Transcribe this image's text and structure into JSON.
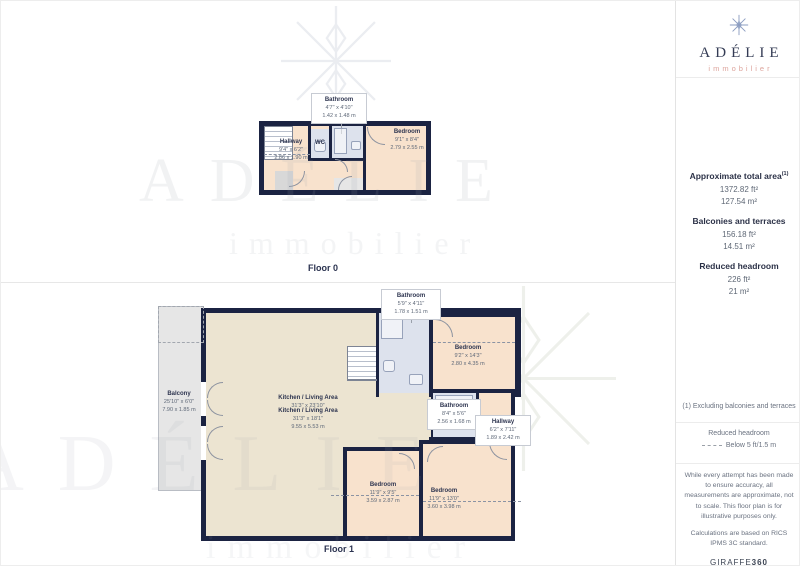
{
  "brand": {
    "name": "ADÉLIE",
    "sub": "immobilier"
  },
  "watermark": {
    "line1": "ADÉLIE",
    "line2": "immobilier"
  },
  "sidebar": {
    "total_area": {
      "label": "Approximate total area",
      "sup": "(1)",
      "ft": "1372.82 ft²",
      "m": "127.54 m²"
    },
    "balconies": {
      "label": "Balconies and terraces",
      "ft": "156.18 ft²",
      "m": "14.51 m²"
    },
    "reduced": {
      "label": "Reduced headroom",
      "ft": "226 ft²",
      "m": "21 m²"
    },
    "note": "(1) Excluding balconies and terraces",
    "legend": {
      "title": "Reduced headroom",
      "item": "Below 5 ft/1.5 m"
    },
    "disclaimer1": "While every attempt has been made to ensure accuracy, all measurements are approximate, not to scale. This floor plan is for illustrative purposes only.",
    "disclaimer2": "Calculations are based on RICS IPMS 3C standard.",
    "giraffe": {
      "name": "GIRAFFE",
      "num": "360"
    }
  },
  "floor0": {
    "label": "Floor 0",
    "rooms": {
      "bathroom_callout": {
        "name": "Bathroom",
        "imperial": "4'7\" x 4'10\"",
        "metric": "1.42 x 1.48 m"
      },
      "hallway": {
        "name": "Hallway",
        "imperial": "9'4\" x 6'2\"",
        "metric": "2.86 x 1.90 m"
      },
      "wc": {
        "name": "WC"
      },
      "bedroom": {
        "name": "Bedroom",
        "imperial": "9'1\" x 8'4\"",
        "metric": "2.79 x 2.55 m"
      }
    }
  },
  "floor1": {
    "label": "Floor 1",
    "rooms": {
      "bathroom_callout": {
        "name": "Bathroom",
        "imperial": "5'9\" x 4'11\"",
        "metric": "1.78 x 1.51 m"
      },
      "balcony": {
        "name": "Balcony",
        "imperial": "25'10\" x 6'0\"",
        "metric": "7.90 x 1.85 m"
      },
      "kitchen_a": {
        "name": "Kitchen / Living Area",
        "imperial": "31'3\" x 23'10\""
      },
      "kitchen_b": {
        "name": "Kitchen / Living Area",
        "imperial": "31'3\" x 18'1\"",
        "metric": "9.55 x 5.53 m"
      },
      "bedroom_tr": {
        "name": "Bedroom",
        "imperial": "9'2\" x 14'3\"",
        "metric": "2.80 x 4.35 m"
      },
      "bathroom_mid": {
        "name": "Bathroom",
        "imperial": "8'4\" x 5'6\"",
        "metric": "2.56 x 1.68 m"
      },
      "hallway": {
        "name": "Hallway",
        "imperial": "6'2\" x 7'11\"",
        "metric": "1.89 x 2.42 m"
      },
      "bedroom_bl": {
        "name": "Bedroom",
        "imperial": "11'9\" x 9'5\"",
        "metric": "3.59 x 2.87 m"
      },
      "bedroom_br": {
        "name": "Bedroom",
        "imperial": "11'9\" x 13'0\"",
        "metric": "3.60 x 3.98 m"
      }
    }
  },
  "colors": {
    "wall": "#1b2342",
    "room_peach": "#f8e2cd",
    "room_cream": "#ece4d1",
    "room_blue": "#dde2ed",
    "balcony_gray": "#e6e6e6",
    "brand_navy": "#343c55",
    "brand_coral": "#dda49c"
  }
}
